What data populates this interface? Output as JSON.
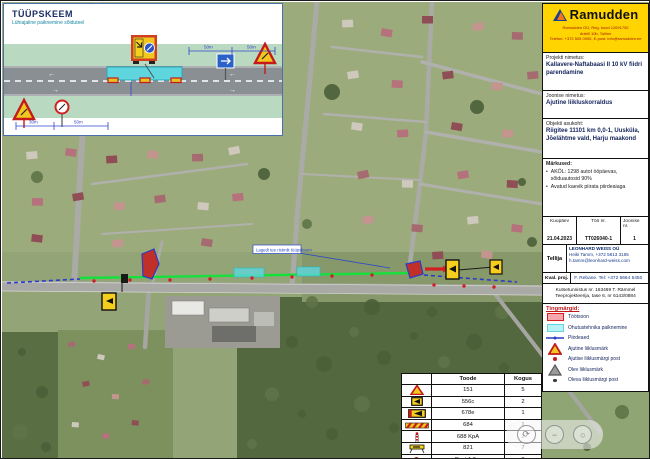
{
  "inset": {
    "title": "TÜÜPSKEEM",
    "subtitle": "Lühiajaline paiknemine sõiduteel",
    "dims": {
      "top1": "50m",
      "top2": "50m",
      "bottom1": "30m",
      "bottom2": "50m"
    }
  },
  "brand": {
    "name": "Ramudden",
    "address_lines": [
      "Ramudden OÜ, Reg. kood 12091792",
      "Artelli 10b, Tallinn",
      "Telefon: +372 505 0000, E-post: info@ramudden.ee"
    ]
  },
  "project": {
    "label": "Projekti nimetus:",
    "value": "Kallavere-Naftabaasi II 10 kV fiidri parendamine"
  },
  "drawing": {
    "label": "Joonise nimetus:",
    "value": "Ajutine liikluskorraldus"
  },
  "location": {
    "label": "Objekti asukoht:",
    "value": "Riigitee 11101 km 0,0-1, Uusküla, Jõelähtme vald, Harju maakond"
  },
  "notes": {
    "label": "Märkused:",
    "items": [
      "AKÖL: 1298 autot ööpäevas, sõiduautosid 90%",
      "Avatud kaevik piirata piirdeaiaga"
    ]
  },
  "meta_table": {
    "headers": [
      "Kuupäev",
      "Töö nr.",
      "Joonise nr."
    ],
    "values": [
      "21.04.2023",
      "TT026040-1",
      "1"
    ]
  },
  "client": {
    "label": "Tellija",
    "lines": [
      "LEONHARD WEISS OÜ",
      "Heiki Tamm, +372 5813 3165",
      "h.tamm@leonhard-weiss.com"
    ]
  },
  "designer": {
    "label": "Kval. proj.",
    "value": "F. Rebane. Tel: +372 5664 5450"
  },
  "certificate": {
    "lines": [
      "Kutsetunnistus nr. 163469 T. Rämmel",
      "Teeprojekteerija, tase 6, nr 6143/0884"
    ]
  },
  "legend": {
    "title": "Tingmärgid:",
    "items": [
      {
        "icon": "work-zone-swatch",
        "label": "Töötsoon"
      },
      {
        "icon": "safety-equipment-swatch",
        "label": "Ohutustehnika paiknemine"
      },
      {
        "icon": "fence-line",
        "label": "Piirdeaed"
      },
      {
        "icon": "temporary-sign",
        "label": "Ajutine liiklusmärk"
      },
      {
        "icon": "temporary-sign-post",
        "label": "Ajutise liiklusmärgi post"
      },
      {
        "icon": "existing-sign",
        "label": "Olev liiklusmärk"
      },
      {
        "icon": "existing-sign-post",
        "label": "Oleva liiklusmärgi post"
      }
    ]
  },
  "products_table": {
    "headers": [
      "Toode",
      "Kogus"
    ],
    "rows": [
      {
        "icon": "warning-triangle-sign",
        "toode": "151",
        "kogus": "5"
      },
      {
        "icon": "arrow-panel-small",
        "toode": "556c",
        "kogus": "2"
      },
      {
        "icon": "arrow-panel-large",
        "toode": "678e",
        "kogus": "1"
      },
      {
        "icon": "striped-barrier-board",
        "toode": "684",
        "kogus": "1"
      },
      {
        "icon": "delineator-post-lamp",
        "toode": "688 KpA",
        "kogus": "2"
      },
      {
        "icon": "barrier-stand",
        "toode": "821",
        "kogus": "7"
      },
      {
        "icon": "plastic-post",
        "toode": "Post 1,5m",
        "kogus": "9"
      }
    ]
  },
  "map": {
    "callout_label": "Lagedi tee ristmik tüüpskeem"
  },
  "viewer_controls": {
    "glyphs": [
      "⟳",
      "−",
      "○"
    ]
  },
  "colors": {
    "brand_yellow": "#ffd400",
    "work_zone_red": "#c03028",
    "safety_cyan": "#5fd6de",
    "route_green": "#16e03c",
    "fence_blue": "#2a3cc8"
  }
}
